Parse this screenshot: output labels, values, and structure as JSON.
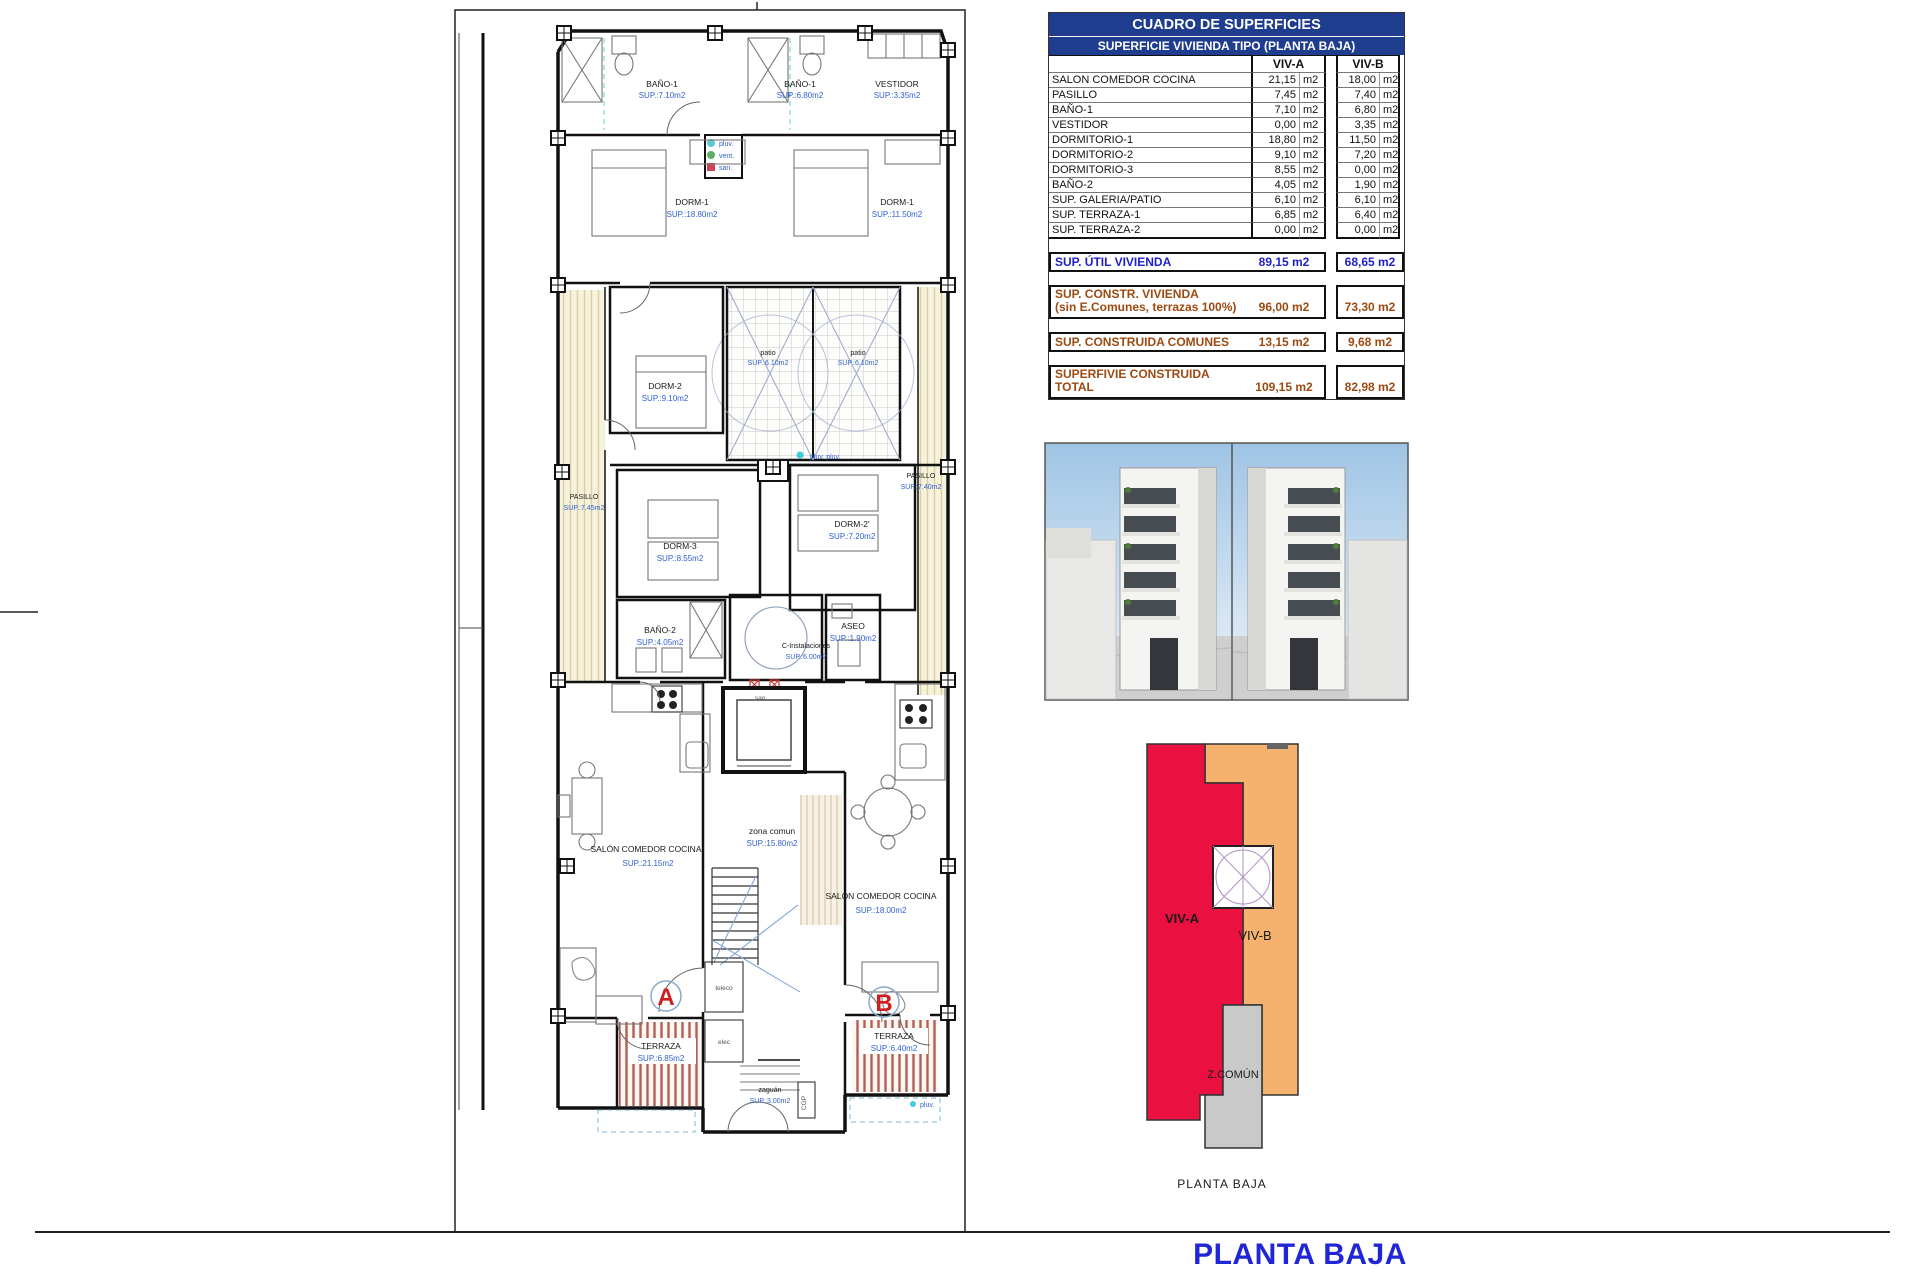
{
  "colors": {
    "header_navy": "#1e3d8f",
    "summary_blue": "#1f1fc8",
    "summary_brown": "#9c4a12",
    "plan_blue": "#2f5fd0",
    "viv_a_red": "#ea1040",
    "viv_b_orange": "#f4b26e",
    "comun_gray": "#c9c9c9",
    "caption_pink": "#e888b8",
    "title_blue": "#2025d8"
  },
  "table": {
    "title": "CUADRO DE SUPERFICIES",
    "subtitle": "SUPERFICIE VIVIENDA TIPO (PLANTA BAJA)",
    "col_a": "VIV-A",
    "col_b": "VIV-B",
    "unit": "m2",
    "rows": [
      {
        "name": "SALON COMEDOR COCINA",
        "a": "21,15",
        "b": "18,00"
      },
      {
        "name": "PASILLO",
        "a": "7,45",
        "b": "7,40"
      },
      {
        "name": "BAÑO-1",
        "a": "7,10",
        "b": "6,80"
      },
      {
        "name": "VESTIDOR",
        "a": "0,00",
        "b": "3,35"
      },
      {
        "name": "DORMITORIO-1",
        "a": "18,80",
        "b": "11,50"
      },
      {
        "name": "DORMITORIO-2",
        "a": "9,10",
        "b": "7,20"
      },
      {
        "name": "DORMITORIO-3",
        "a": "8,55",
        "b": "0,00"
      },
      {
        "name": "BAÑO-2",
        "a": "4,05",
        "b": "1,90"
      },
      {
        "name": "SUP. GALERIA/PATIO",
        "a": "6,10",
        "b": "6,10"
      },
      {
        "name": "SUP. TERRAZA-1",
        "a": "6,85",
        "b": "6,40"
      },
      {
        "name": "SUP. TERRAZA-2",
        "a": "0,00",
        "b": "0,00"
      }
    ],
    "util": {
      "label": "SUP. ÚTIL VIVIENDA",
      "a": "89,15 m2",
      "b": "68,65 m2"
    },
    "constr": {
      "label1": "SUP. CONSTR. VIVIENDA",
      "label2": "(sin E.Comunes, terrazas 100%)",
      "a": "96,00 m2",
      "b": "73,30 m2"
    },
    "comunes": {
      "label": "SUP. CONSTRUIDA COMUNES",
      "a": "13,15 m2",
      "b": "9,68 m2"
    },
    "total": {
      "label1": "SUPERFIVIE CONSTRUIDA",
      "label2": "TOTAL",
      "a": "109,15 m2",
      "b": "82,98 m2"
    }
  },
  "plan": {
    "rooms": [
      {
        "name": "BAÑO-1",
        "sup": "SUP.:7.10m2"
      },
      {
        "name": "BAÑO-1",
        "sup": "SUP.:6.80m2"
      },
      {
        "name": "VESTIDOR",
        "sup": "SUP.:3.35m2"
      },
      {
        "name": "DORM-1",
        "sup": "SUP.:18.80m2"
      },
      {
        "name": "DORM-1",
        "sup": "SUP.:11.50m2"
      },
      {
        "name": "DORM-2",
        "sup": "SUP.:9.10m2"
      },
      {
        "name": "patio",
        "sup": "SUP.:6.10m2"
      },
      {
        "name": "patio",
        "sup": "SUP.:6.10m2"
      },
      {
        "name": "PASILLO",
        "sup": "SUP.:7.45m2"
      },
      {
        "name": "PASILLO",
        "sup": "SUP.:7.40m2"
      },
      {
        "name": "DORM-3",
        "sup": "SUP.:8.55m2"
      },
      {
        "name": "DORM-2'",
        "sup": "SUP.:7.20m2"
      },
      {
        "name": "BAÑO-2",
        "sup": "SUP.:4.05m2"
      },
      {
        "name": "C-Instalaciones",
        "sup": "SUP.:6.00m2"
      },
      {
        "name": "ASEO",
        "sup": "SUP.:1.90m2"
      },
      {
        "name": "zona comun",
        "sup": "SUP.:15.80m2"
      },
      {
        "name": "SALÓN COMEDOR COCINA",
        "sup": "SUP.:21.15m2"
      },
      {
        "name": "SALÓN COMEDOR COCINA",
        "sup": "SUP.:18.00m2"
      },
      {
        "name": "TERRAZA",
        "sup": "SUP.:6.85m2"
      },
      {
        "name": "TERRAZA",
        "sup": "SUP.:6.40m2"
      },
      {
        "name": "zaguán",
        "sup": "SUP.:3.00m2"
      }
    ],
    "legend": {
      "pluv": "pluv.",
      "vent": "vent.",
      "san": "san."
    },
    "labels": {
      "pluv_pluv": "pluv. pluv.",
      "san": "san.",
      "unit_a": "A",
      "unit_b": "B",
      "teleco": "teleco",
      "elec": "elec",
      "cgp": "CGP",
      "pluv_bottom": "pluv."
    }
  },
  "schematic": {
    "viv_a": "VIV-A",
    "viv_b": "VIV-B",
    "z_comun": "Z.COMÚN",
    "caption": "PLANTA BAJA"
  },
  "sheet": {
    "title": "PLANTA BAJA"
  }
}
